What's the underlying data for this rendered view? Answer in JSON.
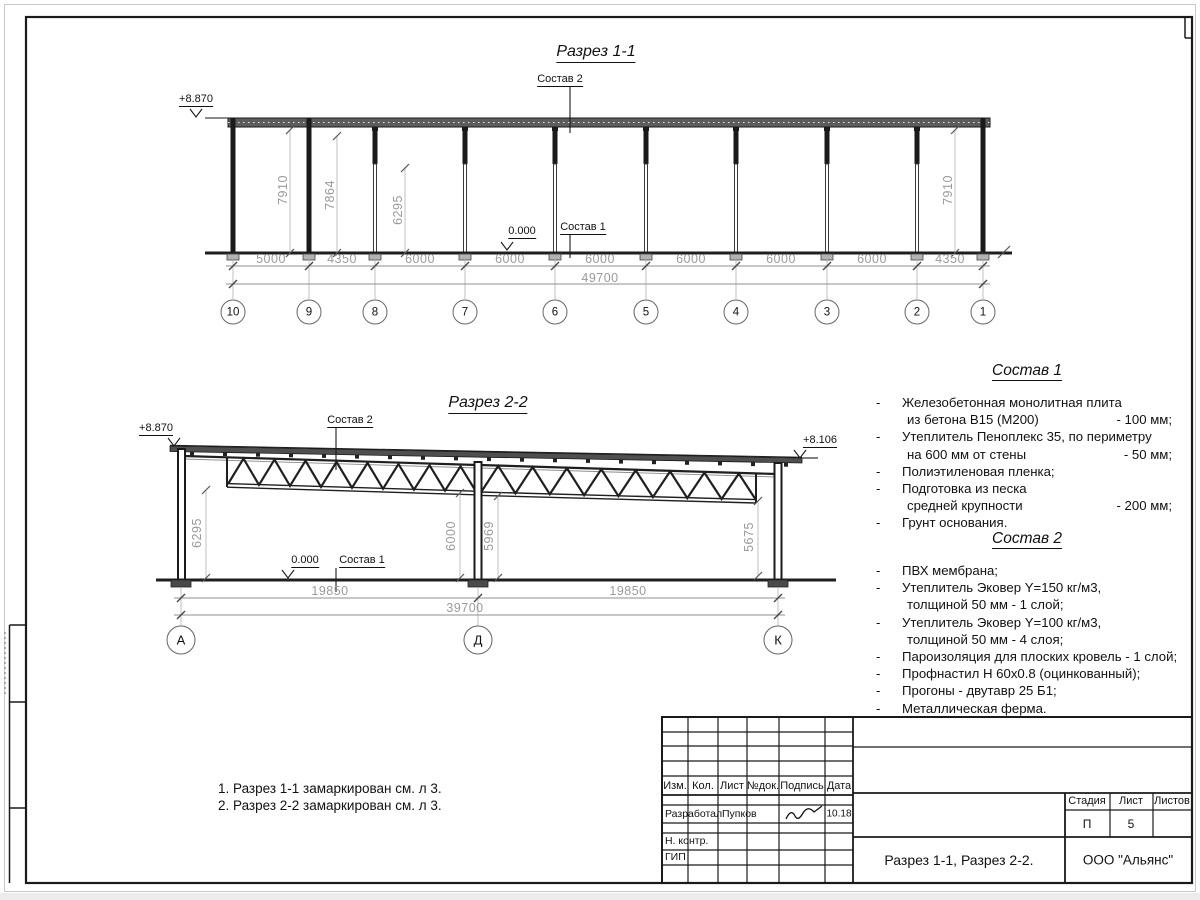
{
  "razrez1": {
    "title": "Разрез 1-1",
    "sostav2_label": "Состав 2",
    "sostav1_label": "Состав 1",
    "level_top": "+8.870",
    "level_zero": "0.000",
    "h_dims": [
      "7910",
      "7864",
      "6295",
      "7910"
    ],
    "bay_dims": [
      "5000",
      "4350",
      "6000",
      "6000",
      "6000",
      "6000",
      "6000",
      "6000",
      "4350"
    ],
    "total": "49700",
    "grids": [
      "10",
      "9",
      "8",
      "7",
      "6",
      "5",
      "4",
      "3",
      "2",
      "1"
    ]
  },
  "razrez2": {
    "title": "Разрез 2-2",
    "sostav2_label": "Состав 2",
    "sostav1_label": "Состав 1",
    "level_left": "+8.870",
    "level_right": "+8.106",
    "level_zero": "0.000",
    "h_dims": [
      "6295",
      "6000",
      "5969",
      "5675"
    ],
    "span_dims": [
      "19850",
      "19850"
    ],
    "total": "39700",
    "grids": [
      "А",
      "Д",
      "К"
    ]
  },
  "sostav1": {
    "title": "Состав 1",
    "items": [
      {
        "dash": "-",
        "text": "Железобетонная  монолитная плита",
        "value": ""
      },
      {
        "dash": "",
        "text": "из бетона В15 (М200)",
        "value": "- 100 мм;"
      },
      {
        "dash": "-",
        "text": "Утеплитель Пеноплекс 35, по периметру",
        "value": ""
      },
      {
        "dash": "",
        "text": "на 600 мм от стены",
        "value": "- 50 мм;"
      },
      {
        "dash": "-",
        "text": "Полиэтиленовая пленка;",
        "value": ""
      },
      {
        "dash": "-",
        "text": "Подготовка из песка",
        "value": ""
      },
      {
        "dash": "",
        "text": "средней крупности",
        "value": "- 200 мм;"
      },
      {
        "dash": "-",
        "text": "Грунт основания.",
        "value": ""
      }
    ]
  },
  "sostav2": {
    "title": "Состав 2",
    "items": [
      {
        "dash": "-",
        "text": "ПВХ мембрана;",
        "value": ""
      },
      {
        "dash": "-",
        "text": "Утеплитель Эковер Y=150 кг/м3,",
        "value": ""
      },
      {
        "dash": "",
        "text": "толщиной 50 мм - 1 слой;",
        "value": ""
      },
      {
        "dash": "-",
        "text": "Утеплитель Эковер Y=100 кг/м3,",
        "value": ""
      },
      {
        "dash": "",
        "text": "толщиной 50 мм - 4 слоя;",
        "value": ""
      },
      {
        "dash": "-",
        "text": "Пароизоляция для плоских кровель - 1 слой;",
        "value": ""
      },
      {
        "dash": "-",
        "text": "Профнастил Н 60х0.8 (оцинкованный);",
        "value": ""
      },
      {
        "dash": "-",
        "text": "Прогоны - двутавр 25 Б1;",
        "value": ""
      },
      {
        "dash": "-",
        "text": "Металлическая ферма.",
        "value": ""
      }
    ]
  },
  "notes": [
    "1. Разрез 1-1 замаркирован см. л 3.",
    "2. Разрез 2-2 замаркирован см. л 3."
  ],
  "titleblock": {
    "headers": {
      "izm": "Изм.",
      "kol": "Кол.",
      "list": "Лист",
      "ndok": "№док.",
      "podpis": "Подпись",
      "data": "Дата"
    },
    "razrabotal_label": "Разработал",
    "razrabotal_name": "Пупков",
    "razrabotal_date": "10.18",
    "nkontr_label": "Н. контр.",
    "gip_label": "ГИП",
    "stadia_label": "Стадия",
    "list_label": "Лист",
    "listov_label": "Листов",
    "stadia_value": "П",
    "list_value": "5",
    "listov_value": "",
    "doc_title": "Разрез 1-1, Разрез 2-2.",
    "company": "ООО \"Альянс\""
  }
}
